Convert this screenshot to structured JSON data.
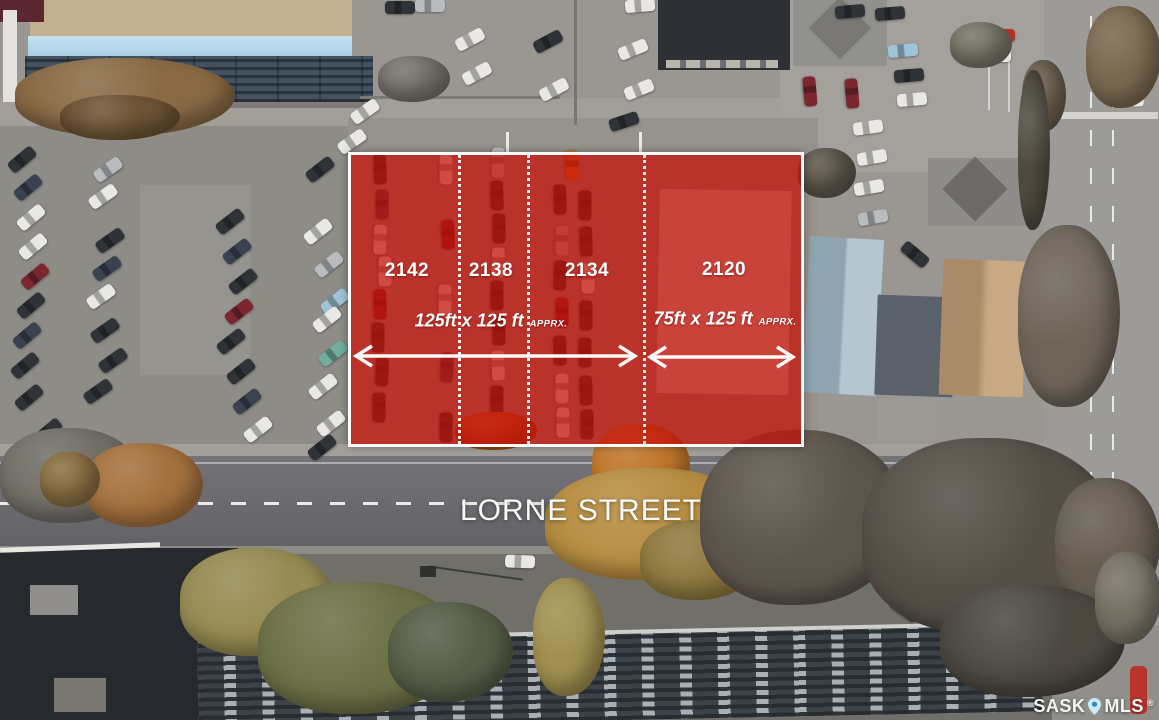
{
  "image_type": "aerial-property-listing-photo",
  "overlay": {
    "fill_color": "#c80e06",
    "border_color": "#ffffff",
    "lots": [
      {
        "number": "2142"
      },
      {
        "number": "2138"
      },
      {
        "number": "2134"
      },
      {
        "number": "2120"
      }
    ],
    "dimensions": [
      {
        "size": "125ft  x 125 ft",
        "qualifier": "APPRX."
      },
      {
        "size": "75ft x 125 ft",
        "qualifier": "APPRX."
      }
    ]
  },
  "street": {
    "name": "LORNE STREET"
  },
  "watermark": {
    "brand_left": "SASK",
    "brand_right": "MLS",
    "registered": "®",
    "pin_icon": "map-pin-icon",
    "pin_color": "#cdeaf8"
  }
}
